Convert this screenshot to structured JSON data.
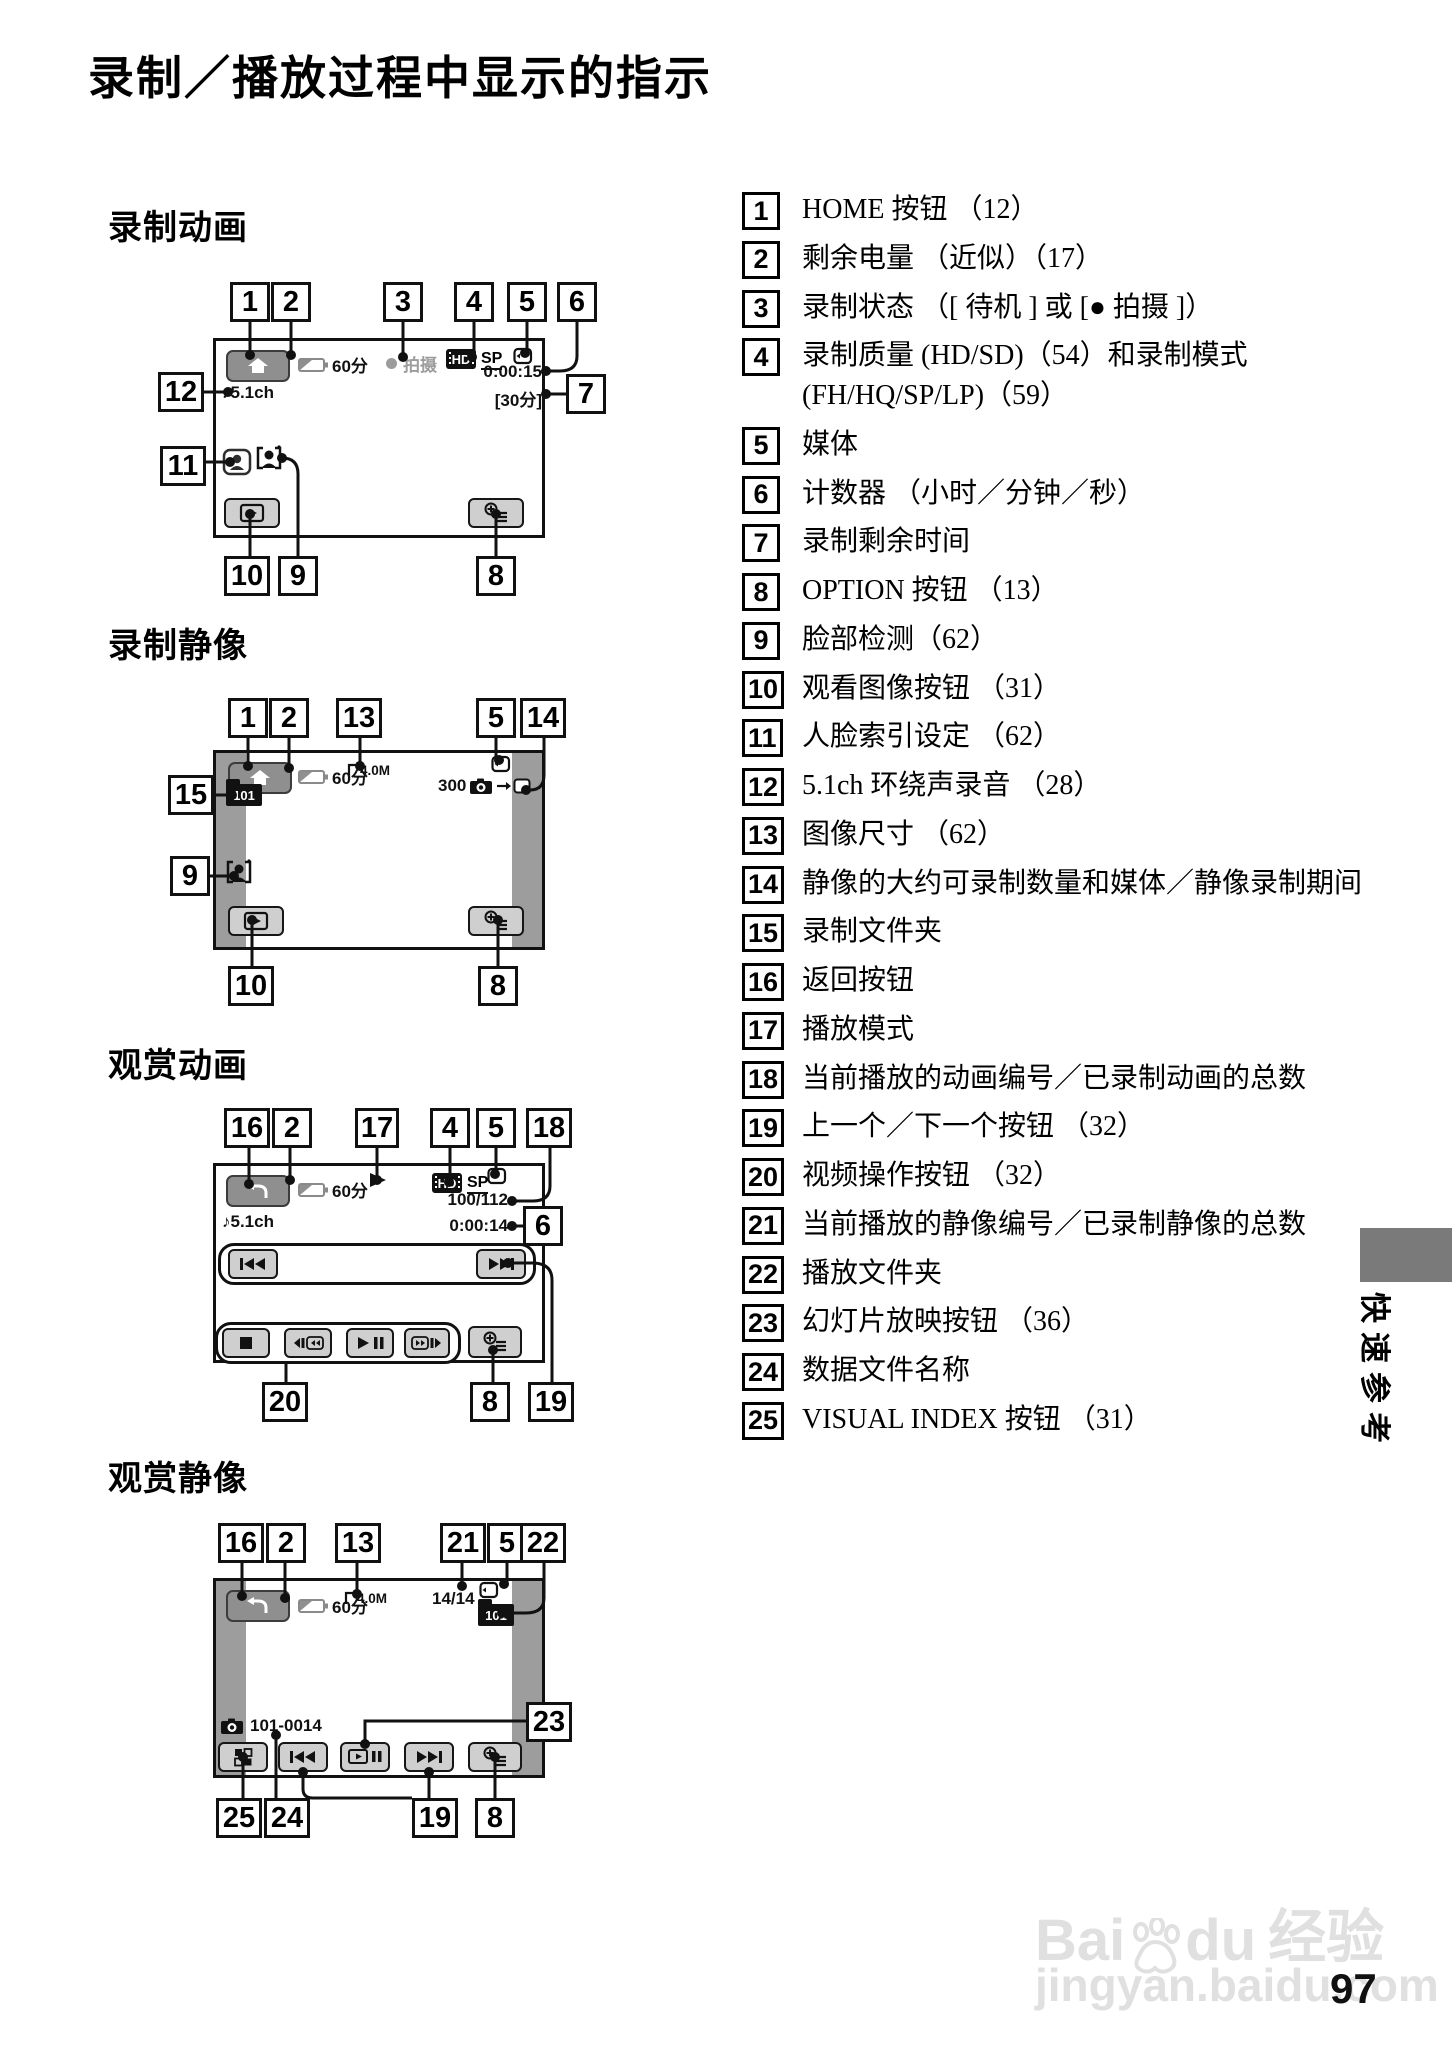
{
  "page": {
    "title": "录制／播放过程中显示的指示",
    "page_number": "97",
    "side_tab": "快速参考",
    "watermark": {
      "brand_left": "Bai",
      "brand_right": "du",
      "brand_zh": "经验",
      "url": "jingyan.baidu.com"
    }
  },
  "d1": {
    "heading": "录制动画",
    "battery": "60分",
    "status": "拍摄",
    "hd": "HD",
    "sp": "SP",
    "counter": "0:00:15",
    "remaining": "[30分]",
    "audio": "♪5.1ch",
    "co": [
      "1",
      "2",
      "3",
      "4",
      "5",
      "6",
      "7",
      "8",
      "9",
      "10",
      "11",
      "12"
    ]
  },
  "d2": {
    "heading": "录制静像",
    "battery": "60分",
    "size": "4.0M",
    "count": "300",
    "folder": "101",
    "co": [
      "1",
      "2",
      "13",
      "5",
      "14",
      "15",
      "9",
      "10",
      "8"
    ]
  },
  "d3": {
    "heading": "观赏动画",
    "battery": "60分",
    "hd": "HD",
    "sp": "SP",
    "index": "100/112",
    "counter": "0:00:14",
    "audio": "♪5.1ch",
    "co": [
      "16",
      "2",
      "17",
      "4",
      "5",
      "18",
      "6",
      "19",
      "20",
      "8"
    ]
  },
  "d4": {
    "heading": "观赏静像",
    "battery": "60分",
    "size": "4.0M",
    "index": "14/14",
    "folder": "101",
    "file": "101-0014",
    "co": [
      "16",
      "2",
      "13",
      "21",
      "5",
      "22",
      "23",
      "25",
      "24",
      "19",
      "8"
    ]
  },
  "legend": [
    {
      "num": "1",
      "text": "HOME 按钮 （12）"
    },
    {
      "num": "2",
      "text": "剩余电量 （近似）（17）"
    },
    {
      "num": "3",
      "text": "录制状态 （[ 待机 ] 或 [● 拍摄 ]）"
    },
    {
      "num": "4",
      "text": "录制质量 (HD/SD)（54）和录制模式 (FH/HQ/SP/LP)（59）"
    },
    {
      "num": "5",
      "text": "媒体"
    },
    {
      "num": "6",
      "text": "计数器 （小时／分钟／秒）"
    },
    {
      "num": "7",
      "text": "录制剩余时间"
    },
    {
      "num": "8",
      "text": "OPTION 按钮 （13）"
    },
    {
      "num": "9",
      "text": "脸部检测（62）"
    },
    {
      "num": "10",
      "text": "观看图像按钮 （31）"
    },
    {
      "num": "11",
      "text": "人脸索引设定 （62）"
    },
    {
      "num": "12",
      "text": "5.1ch 环绕声录音 （28）"
    },
    {
      "num": "13",
      "text": "图像尺寸 （62）"
    },
    {
      "num": "14",
      "text": "静像的大约可录制数量和媒体／静像录制期间"
    },
    {
      "num": "15",
      "text": "录制文件夹"
    },
    {
      "num": "16",
      "text": "返回按钮"
    },
    {
      "num": "17",
      "text": "播放模式"
    },
    {
      "num": "18",
      "text": "当前播放的动画编号／已录制动画的总数"
    },
    {
      "num": "19",
      "text": "上一个／下一个按钮 （32）"
    },
    {
      "num": "20",
      "text": "视频操作按钮 （32）"
    },
    {
      "num": "21",
      "text": "当前播放的静像编号／已录制静像的总数"
    },
    {
      "num": "22",
      "text": "播放文件夹"
    },
    {
      "num": "23",
      "text": "幻灯片放映按钮 （36）"
    },
    {
      "num": "24",
      "text": "数据文件名称"
    },
    {
      "num": "25",
      "text": "VISUAL INDEX 按钮 （31）"
    }
  ]
}
